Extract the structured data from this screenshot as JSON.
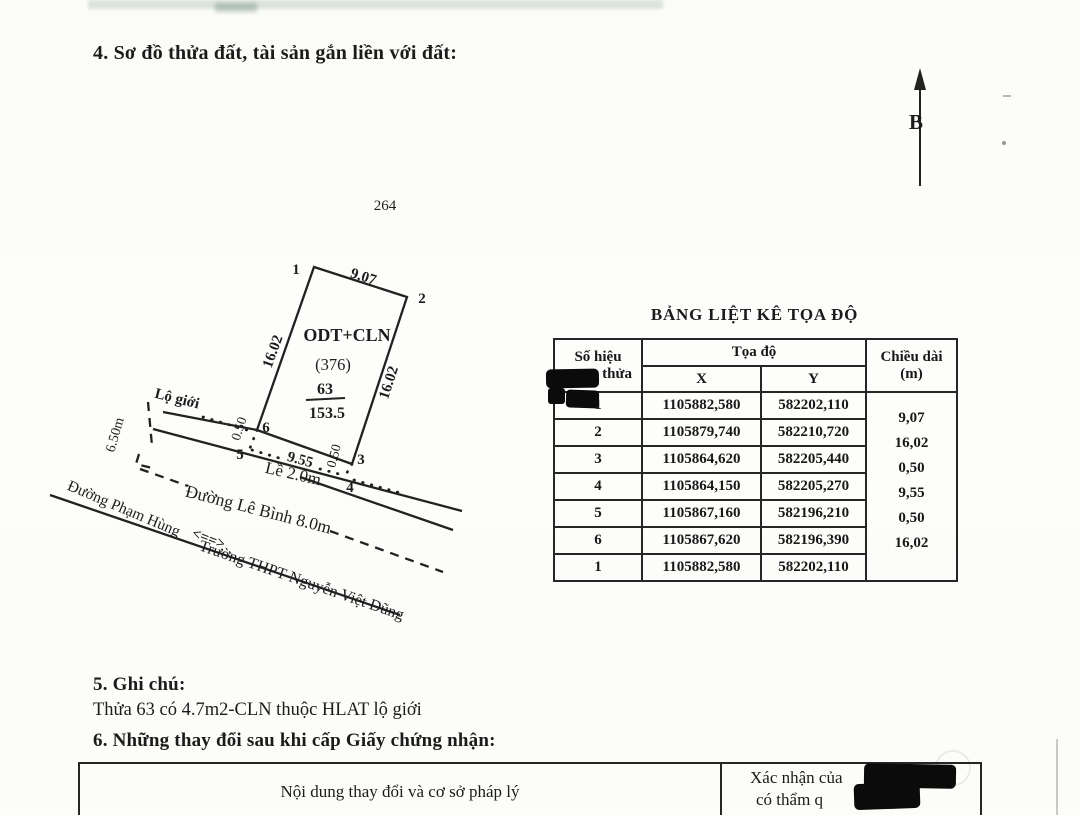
{
  "page": {
    "section4_title": "4. Sơ đồ thửa đất, tài sản gắn liền với đất:",
    "section5_title": "5. Ghi chú:",
    "section5_note": "Thửa 63 có 4.7m2-CLN thuộc HLAT lộ giới",
    "section6_title": "6. Những thay đổi sau khi cấp Giấy chứng nhận:"
  },
  "diagram": {
    "north_label": "B",
    "map_number": "264",
    "plot": {
      "land_use": "ODT+CLN",
      "code": "(376)",
      "number": "63",
      "area": "153.5"
    },
    "corners": [
      "1",
      "2",
      "3",
      "4",
      "5",
      "6"
    ],
    "edges": {
      "top": "9.07",
      "left": "16.02",
      "right": "16.02",
      "bottom": "9.55",
      "jog_left": "0.50",
      "jog_right": "0.50"
    },
    "labels": {
      "lo_gioi": "Lộ giới",
      "setback": "6.50m",
      "sidewalk": "Lề 2.0m",
      "road": "Đường Lê Bình 8.0m",
      "dir_from": "Đường Phạm Hùng",
      "dir_arrow": "<==>",
      "dir_to": "Trường THPT Nguyễn Việt Dũng"
    }
  },
  "coord_table": {
    "title": "BẢNG LIỆT KÊ TỌA ĐỘ",
    "header": {
      "no_line1": "Số hiệu",
      "no_line2": "thửa",
      "coords": "Tọa độ",
      "x": "X",
      "y": "Y",
      "len_line1": "Chiều dài",
      "len_line2": "(m)"
    },
    "rows": [
      {
        "no": "1",
        "x": "1105882,580",
        "y": "582202,110"
      },
      {
        "no": "2",
        "x": "1105879,740",
        "y": "582210,720"
      },
      {
        "no": "3",
        "x": "1105864,620",
        "y": "582205,440"
      },
      {
        "no": "4",
        "x": "1105864,150",
        "y": "582205,270"
      },
      {
        "no": "5",
        "x": "1105867,160",
        "y": "582196,210"
      },
      {
        "no": "6",
        "x": "1105867,620",
        "y": "582196,390"
      },
      {
        "no": "1",
        "x": "1105882,580",
        "y": "582202,110"
      }
    ],
    "lengths": [
      "9,07",
      "16,02",
      "0,50",
      "9,55",
      "0,50",
      "16,02"
    ]
  },
  "changes_table": {
    "left_header": "Nội dung thay đổi và cơ sở pháp lý",
    "right_header_line1": "Xác nhận của",
    "right_header_line2": "có thẩm q"
  }
}
